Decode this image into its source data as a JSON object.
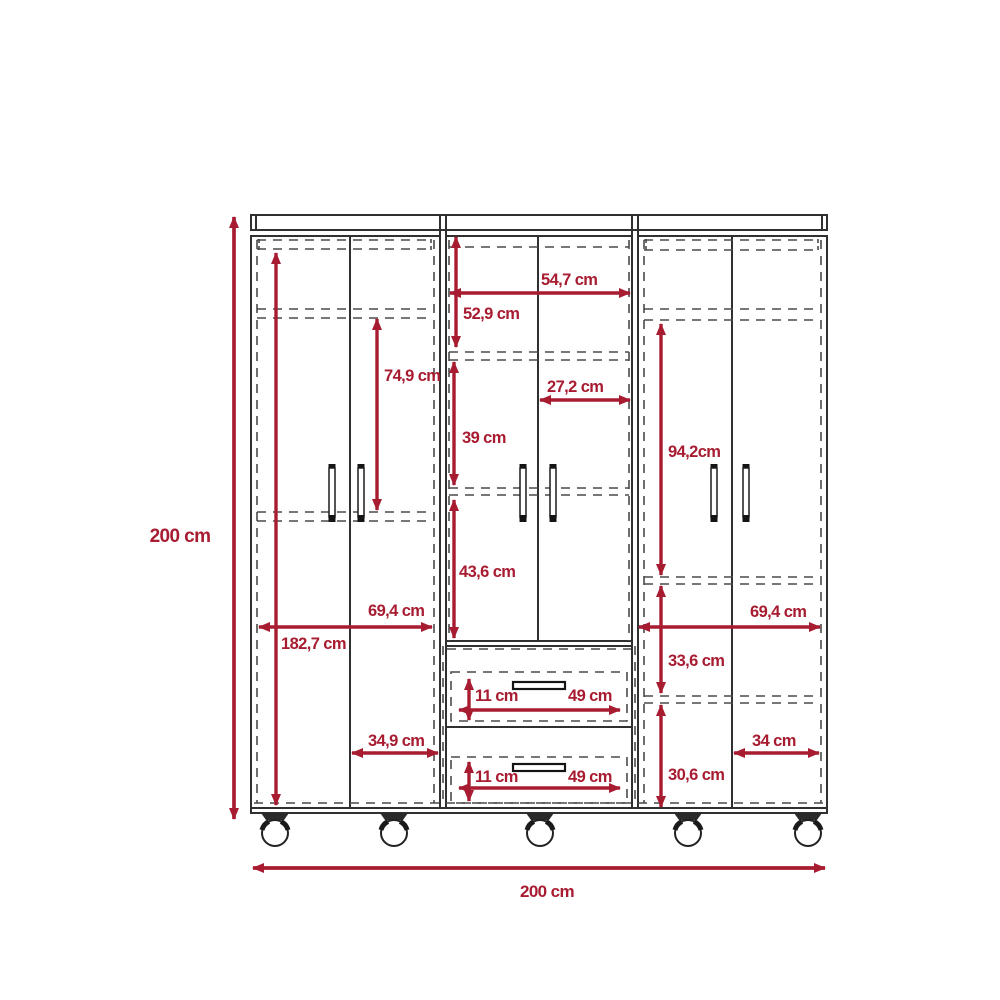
{
  "diagram": {
    "type": "furniture-dimension-diagram",
    "subject": "Three-module six-door wardrobe with two center drawers on casters",
    "unit": "cm",
    "colors": {
      "dimension_accent": "#a81c31",
      "structure_line": "#303030",
      "hidden_edge": "#4a4a4a",
      "background": "#ffffff"
    },
    "counts": {
      "doors": 6,
      "drawers": 2,
      "casters": 5,
      "door_handles": 6,
      "drawer_handles": 2
    },
    "labels": {
      "overall_height": "200 cm",
      "overall_width": "200 cm",
      "interior_height": "182,7 cm",
      "left_upper_section_height": "74,9 cm",
      "left_doors_width": "69,4 cm",
      "left_door_width": "34,9 cm",
      "center_top_width": "54,7 cm",
      "center_top_height": "52,9 cm",
      "center_middle_height": "39 cm",
      "center_door_width": "27,2 cm",
      "center_lower_height": "43,6 cm",
      "right_hanging_height": "94,2cm",
      "right_doors_width": "69,4 cm",
      "right_upper_gap": "33,6 cm",
      "right_lower_gap": "30,6 cm",
      "right_door_width": "34 cm",
      "drawer_top_height": "11 cm",
      "drawer_top_width": "49 cm",
      "drawer_bottom_height": "11 cm",
      "drawer_bottom_width": "49 cm"
    }
  }
}
